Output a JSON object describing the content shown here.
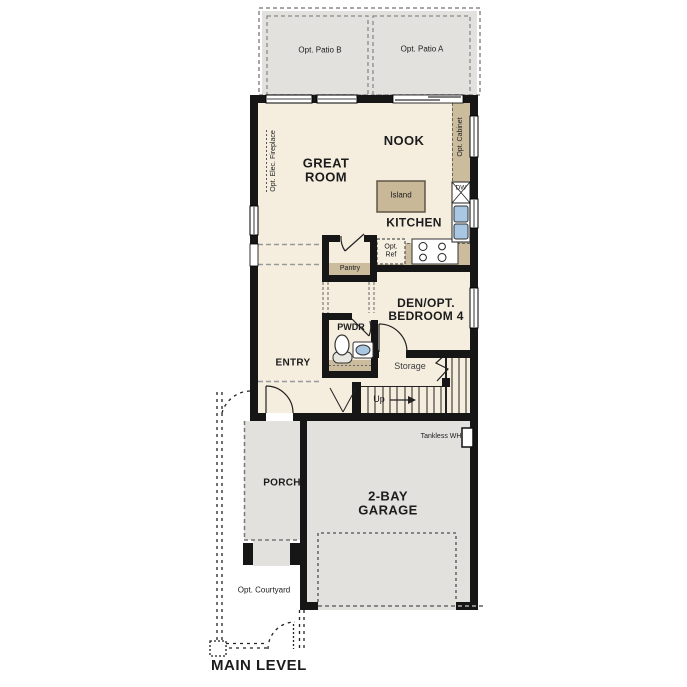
{
  "title": "MAIN LEVEL",
  "colors": {
    "wall": "#161616",
    "floor": "#f5eedf",
    "counter": "#cbbc9e",
    "island": "#c9b897",
    "area_gray": "#e2e1de",
    "sink_blue": "#a9c7e2",
    "dash_gray": "#8a8a8a"
  },
  "labels": {
    "patio_b": "Opt. Patio B",
    "patio_a": "Opt. Patio A",
    "great_room": "GREAT ROOM",
    "nook": "NOOK",
    "kitchen": "KITCHEN",
    "island": "Island",
    "opt_elec_fireplace": "Opt. Elec. Fireplace",
    "opt_cabinet": "Opt. Cabinet",
    "dw": "DW",
    "opt_ref": "Opt. Ref",
    "pantry": "Pantry",
    "den": "DEN/OPT. BEDROOM 4",
    "pwdr": "PWDR",
    "entry": "ENTRY",
    "storage": "Storage",
    "up": "Up",
    "tankless_wh": "Tankless WH",
    "porch": "PORCH",
    "garage": "2-BAY GARAGE",
    "opt_courtyard": "Opt. Courtyard",
    "main_level": "MAIN LEVEL"
  }
}
